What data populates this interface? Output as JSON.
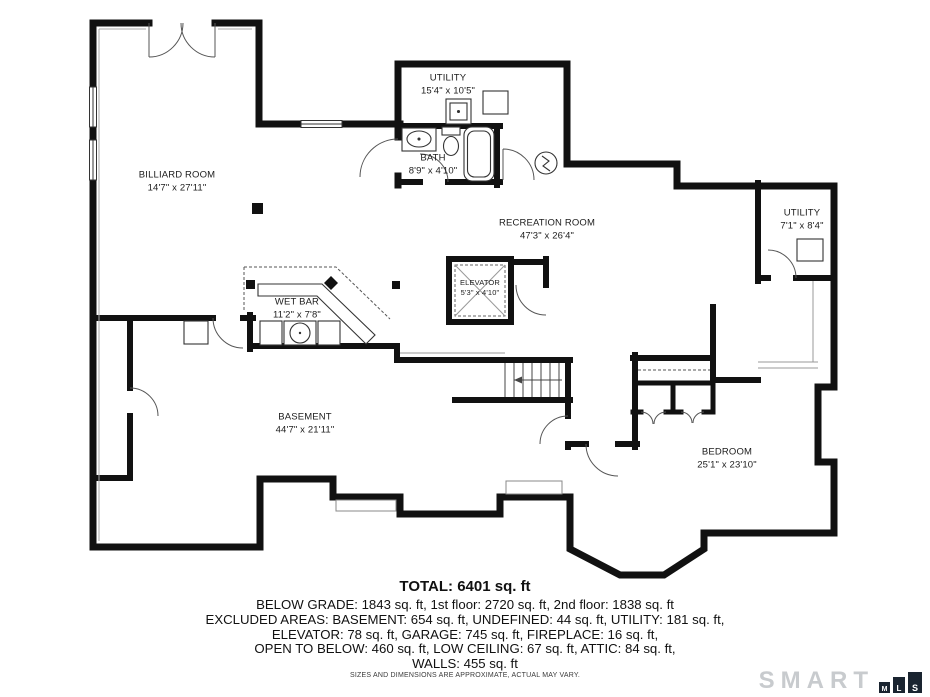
{
  "plan": {
    "rooms": [
      {
        "name": "BILLIARD ROOM",
        "dims": "14'7\" x 27'11\""
      },
      {
        "name": "UTILITY",
        "dims": "15'4\" x 10'5\""
      },
      {
        "name": "BATH",
        "dims": "8'9\" x 4'10\""
      },
      {
        "name": "RECREATION ROOM",
        "dims": "47'3\" x 26'4\""
      },
      {
        "name": "UTILITY",
        "dims": "7'1\" x 8'4\""
      },
      {
        "name": "ELEVATOR",
        "dims": "5'3\" x 4'10\""
      },
      {
        "name": "WET BAR",
        "dims": "11'2\" x 7'8\""
      },
      {
        "name": "BASEMENT",
        "dims": "44'7\" x 21'11\""
      },
      {
        "name": "BEDROOM",
        "dims": "25'1\" x 23'10\""
      }
    ]
  },
  "summary": {
    "total": "TOTAL: 6401 sq. ft",
    "lines": [
      "BELOW GRADE: 1843 sq. ft, 1st floor: 2720 sq. ft, 2nd floor: 1838 sq. ft",
      "EXCLUDED AREAS: BASEMENT: 654 sq. ft, UNDEFINED: 44 sq. ft, UTILITY: 181 sq. ft,",
      "ELEVATOR: 78 sq. ft, GARAGE: 745 sq. ft, FIREPLACE: 16 sq. ft,",
      "OPEN TO BELOW: 460 sq. ft, LOW CEILING: 67 sq. ft, ATTIC: 84 sq. ft,",
      "WALLS: 455 sq. ft"
    ]
  },
  "disclaimer": "SIZES AND DIMENSIONS ARE APPROXIMATE, ACTUAL MAY VARY.",
  "logo": {
    "brand": "SMART",
    "blocks": [
      "M",
      "L",
      "S"
    ]
  },
  "colors": {
    "wall": "#111111",
    "door": "#555555",
    "logo_gray": "#c8cbce",
    "logo_block": "#1a2430"
  }
}
